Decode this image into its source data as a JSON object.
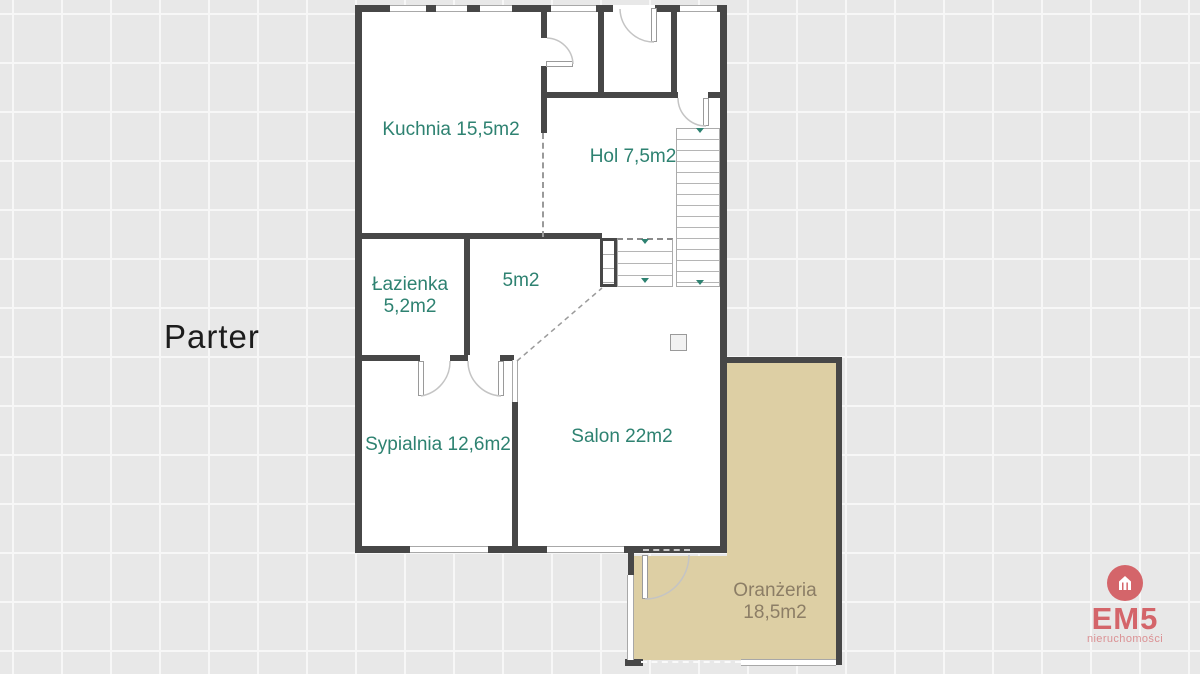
{
  "title": "Parter",
  "rooms": {
    "kuchnia": "Kuchnia 15,5m2",
    "hol": "Hol 7,5m2",
    "lazienka_name": "Łazienka",
    "lazienka_area": "5,2m2",
    "small_room": "5m2",
    "sypialnia": "Sypialnia 12,6m2",
    "salon": "Salon 22m2",
    "oranzeria_name": "Oranżeria",
    "oranzeria_area": "18,5m2"
  },
  "logo": {
    "brand": "EM5",
    "subtitle": "nieruchomości"
  },
  "colors": {
    "background": "#e8e8e8",
    "grid_line": "#f7f7f7",
    "wall": "#474747",
    "room_label": "#2e8271",
    "oranzeria_fill": "#ddcfa4",
    "oranzeria_label": "#8c7e66",
    "stair_arrow": "#2e8271",
    "logo_red": "#d4656a",
    "logo_subtitle": "#db9194",
    "floor_title": "#1c1c1c"
  }
}
